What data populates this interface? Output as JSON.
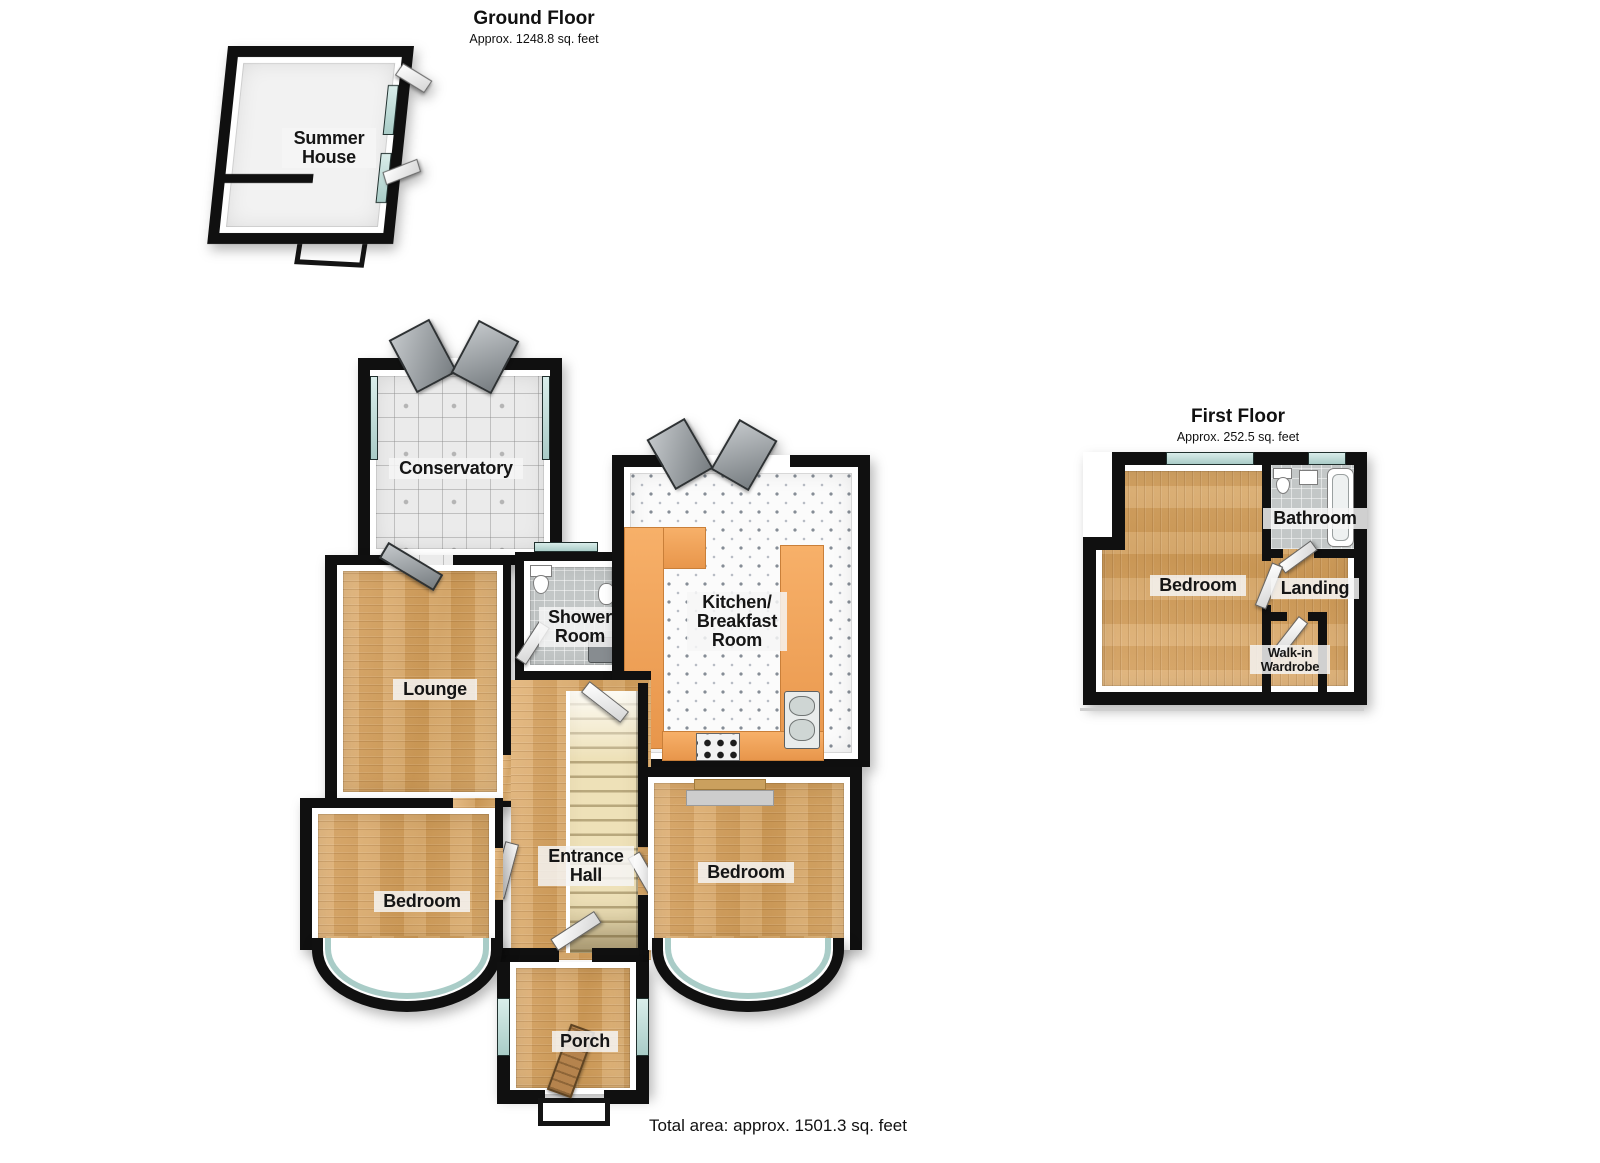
{
  "ground_floor": {
    "title": "Ground Floor",
    "area": "Approx. 1248.8 sq. feet",
    "rooms": {
      "summer_house": "Summer House",
      "conservatory": "Conservatory",
      "lounge": "Lounge",
      "shower_room": "Shower Room",
      "kitchen": "Kitchen/ Breakfast Room",
      "entrance_hall": "Entrance Hall",
      "bedroom_left": "Bedroom",
      "bedroom_right": "Bedroom",
      "porch": "Porch"
    }
  },
  "first_floor": {
    "title": "First Floor",
    "area": "Approx. 252.5 sq. feet",
    "rooms": {
      "bedroom": "Bedroom",
      "bathroom": "Bathroom",
      "landing": "Landing",
      "walk_in_wardrobe": "Walk-in Wardrobe"
    }
  },
  "footer": {
    "total_area": "Total area: approx. 1501.3 sq. feet"
  },
  "colors": {
    "wall": "#101010",
    "wood": "#d5a466",
    "tile": "#ebebeb",
    "bath_tile": "#c3c7c7",
    "window_glass": "#a9ccc7",
    "counter": "#e8964b",
    "stairs": "#eee1b8"
  }
}
